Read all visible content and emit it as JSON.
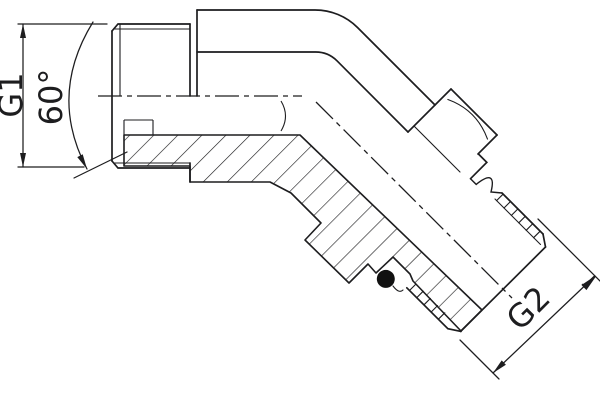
{
  "drawing": {
    "type": "technical-drawing-45deg-elbow-fitting",
    "labels": {
      "g1": "G1",
      "angle": "60°",
      "g2": "G2"
    },
    "colors": {
      "line": "#1d1d1f",
      "background": "#ffffff",
      "seal": "#111111"
    }
  }
}
